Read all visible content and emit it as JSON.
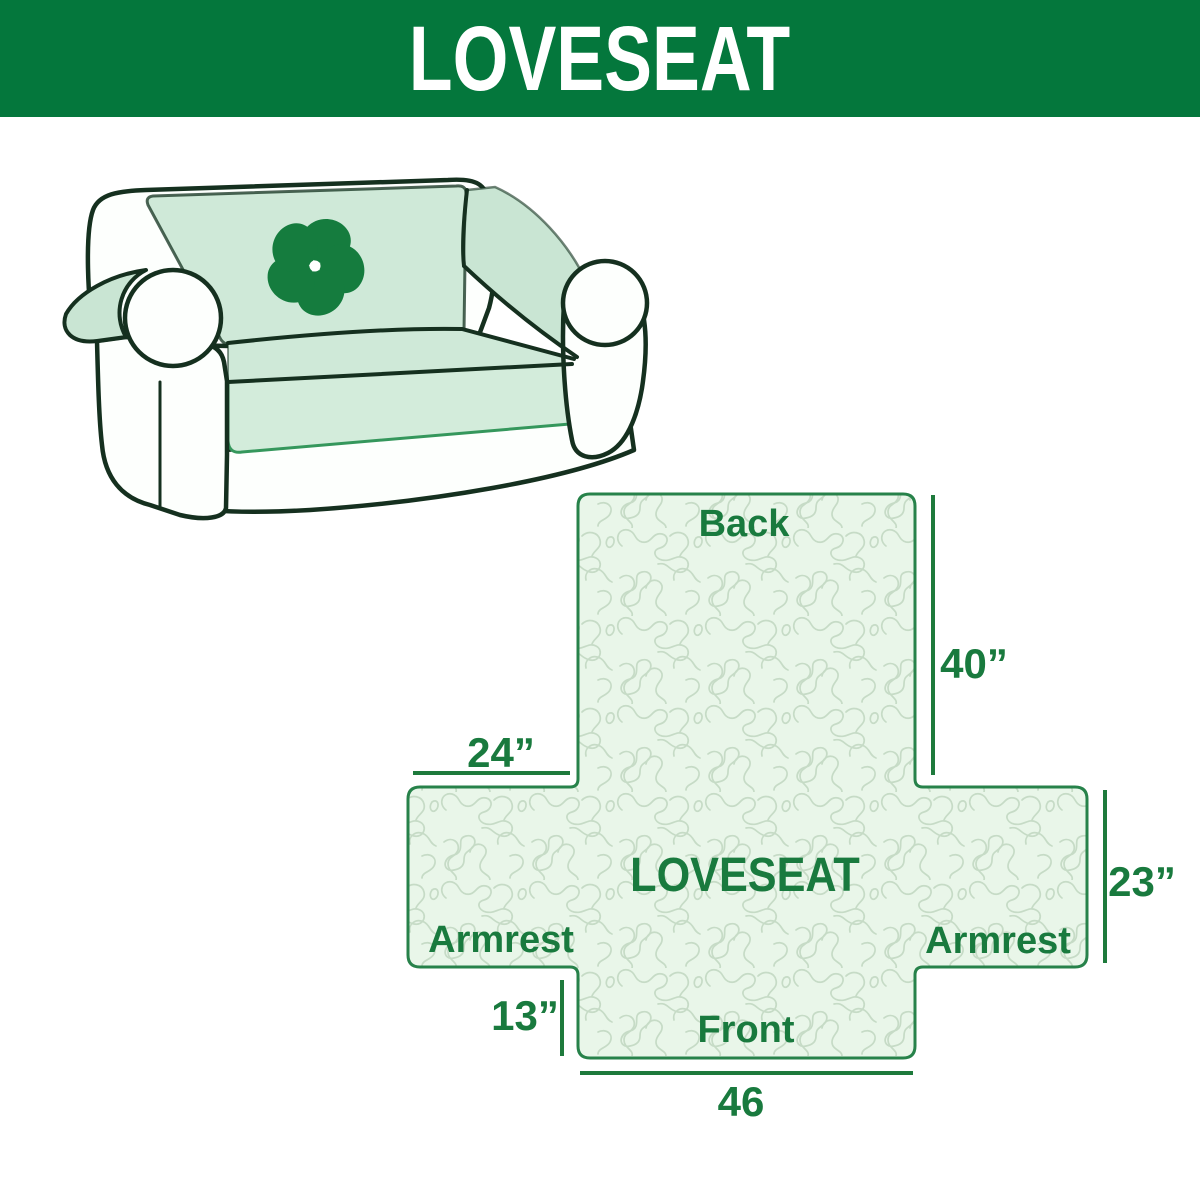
{
  "header": {
    "title": "LOVESEAT"
  },
  "illustration": {
    "description": "loveseat sofa with mint slipcover",
    "logo_icon": "pinwheel-flower"
  },
  "diagram": {
    "center_label": "LOVESEAT",
    "labels": {
      "back": "Back",
      "front": "Front",
      "armrest_left": "Armrest",
      "armrest_right": "Armrest"
    },
    "dimensions": {
      "back_height": "40”",
      "armrest_top_width": "24”",
      "armrest_side_height": "23”",
      "front_drop": "13”",
      "front_width": "46"
    }
  },
  "colors": {
    "header_green": "#04773c",
    "text_green": "#197a3e",
    "diagram_border_green": "#27824a",
    "dimension_line_green": "#1e7a3c",
    "pattern_background": "#e9f6e9",
    "pattern_line": "#c6dbc6",
    "cover_mint": "#cfe9d8",
    "logo_green": "#157c3e",
    "sofa_outline": "#15301f",
    "hem_green": "#35975c"
  }
}
